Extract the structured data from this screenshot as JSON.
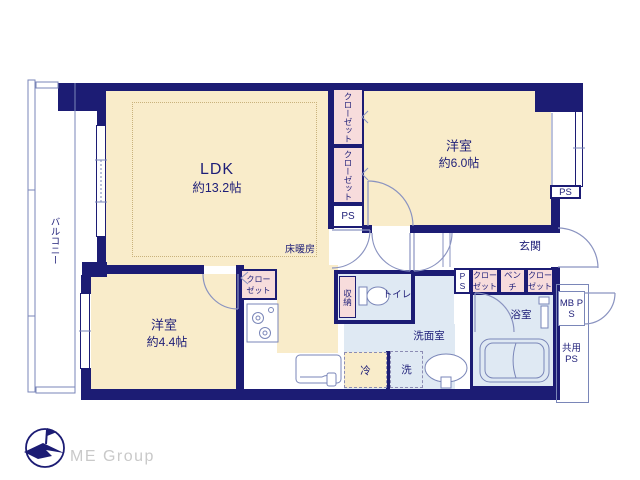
{
  "plan_title": "apartment-floor-plan",
  "colors": {
    "wall": "#1c1c74",
    "room_beige": "#f9ecca",
    "closet_pink": "#f7dcdc",
    "wet_area_blue": "#dfe9f3",
    "thin_line": "#7a86b8",
    "text": "#1e1e78",
    "logo_text": "#c9c9c9"
  },
  "labels": {
    "balcony": "バルコニー",
    "ldk_name": "LDK",
    "ldk_size": "約13.2帖",
    "floor_heating": "床暖房",
    "bedroom1_name": "洋室",
    "bedroom1_size": "約6.0帖",
    "bedroom2_name": "洋室",
    "bedroom2_size": "約4.4帖",
    "entrance": "玄関",
    "closet_v1": "クローゼット",
    "closet_v2": "クローゼット",
    "closet_kitchen": "クローゼット",
    "closet_hall1": "クローゼット",
    "bench": "ベンチ",
    "closet_hall2": "クローゼット",
    "storage": "収納",
    "toilet": "トイレ",
    "washroom": "洗面室",
    "washer": "洗",
    "fridge": "冷",
    "bathroom": "浴室",
    "ps_column": "PS",
    "ps_right": "PS",
    "ps_hall": "PS",
    "mb_ps": "MB PS",
    "shared_ps": "共用PS"
  },
  "logo": {
    "text": "ME Group"
  }
}
